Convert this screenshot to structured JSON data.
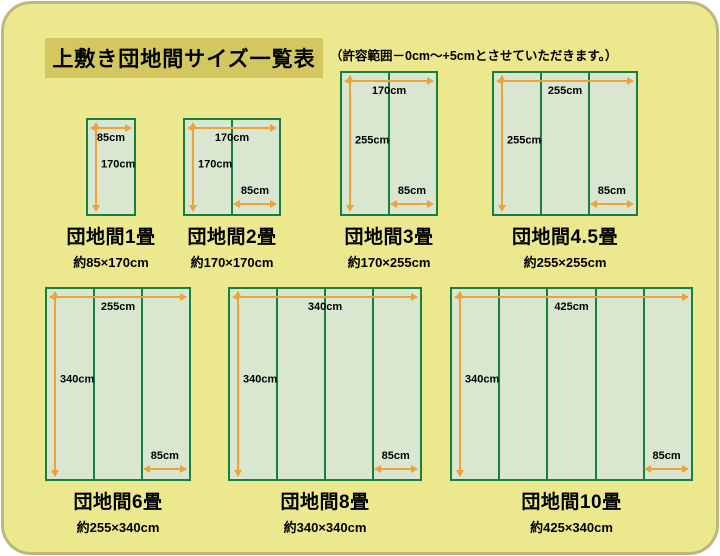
{
  "header": {
    "title": "上敷き団地間サイズ一覧表",
    "note": "（許容範囲－0cm～+5cmとさせていただきます。）"
  },
  "colors": {
    "panel-bg": "#ECE88E",
    "panel-border": "#BDB878",
    "titlebox-bg": "#D3C75F",
    "mat-fill": "#D9E7D1",
    "mat-border": "#17803E",
    "arrow": "#EDA23A",
    "text": "#000000"
  },
  "diagrams": [
    {
      "title": "団地間1畳",
      "size": "約85×170cm",
      "width_label": "85cm",
      "height_label": "170cm",
      "mat_label": "",
      "columns": 1,
      "width_cm": 85,
      "height_cm": 170
    },
    {
      "title": "団地間2畳",
      "size": "約170×170cm",
      "width_label": "170cm",
      "height_label": "170cm",
      "mat_label": "85cm",
      "columns": 2,
      "width_cm": 170,
      "height_cm": 170
    },
    {
      "title": "団地間3畳",
      "size": "約170×255cm",
      "width_label": "170cm",
      "height_label": "255cm",
      "mat_label": "85cm",
      "columns": 2,
      "width_cm": 170,
      "height_cm": 255
    },
    {
      "title": "団地間4.5畳",
      "size": "約255×255cm",
      "width_label": "255cm",
      "height_label": "255cm",
      "mat_label": "85cm",
      "columns": 3,
      "width_cm": 255,
      "height_cm": 255
    },
    {
      "title": "団地間6畳",
      "size": "約255×340cm",
      "width_label": "255cm",
      "height_label": "340cm",
      "mat_label": "85cm",
      "columns": 3,
      "width_cm": 255,
      "height_cm": 340
    },
    {
      "title": "団地間8畳",
      "size": "約340×340cm",
      "width_label": "340cm",
      "height_label": "340cm",
      "mat_label": "85cm",
      "columns": 4,
      "width_cm": 340,
      "height_cm": 340
    },
    {
      "title": "団地間10畳",
      "size": "約425×340cm",
      "width_label": "425cm",
      "height_label": "340cm",
      "mat_label": "85cm",
      "columns": 5,
      "width_cm": 425,
      "height_cm": 340
    }
  ]
}
